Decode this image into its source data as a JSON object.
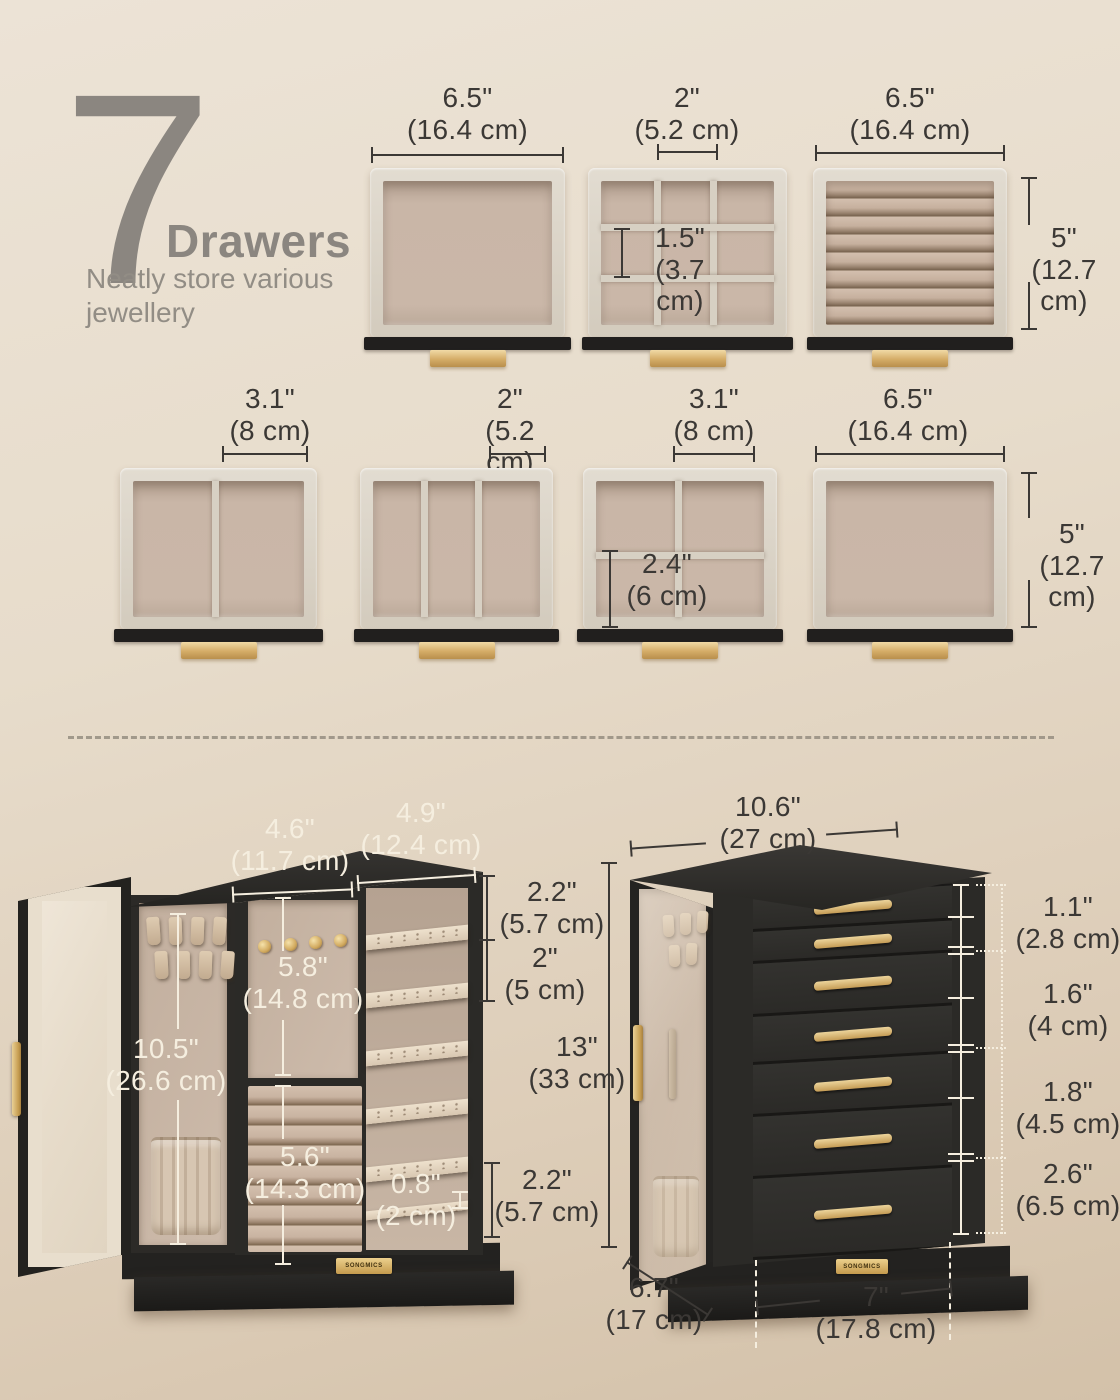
{
  "title": {
    "number": "7",
    "word": "Drawers",
    "subtitle_line1": "Neatly store various",
    "subtitle_line2": "jewellery"
  },
  "row1": [
    {
      "width_in": "6.5\"",
      "width_cm": "(16.4 cm)"
    },
    {
      "width_in": "2\"",
      "width_cm": "(5.2 cm)",
      "cell_in": "1.5\"",
      "cell_cm": "(3.7 cm)"
    },
    {
      "width_in": "6.5\"",
      "width_cm": "(16.4 cm)",
      "height_in": "5\"",
      "height_cm": "(12.7 cm)"
    }
  ],
  "row2": [
    {
      "width_in": "3.1\"",
      "width_cm": "(8 cm)"
    },
    {
      "width_in": "2\"",
      "width_cm": "(5.2 cm)"
    },
    {
      "width_in": "3.1\"",
      "width_cm": "(8 cm)",
      "cell_in": "2.4\"",
      "cell_cm": "(6 cm)"
    },
    {
      "width_in": "6.5\"",
      "width_cm": "(16.4 cm)",
      "height_in": "5\"",
      "height_cm": "(12.7 cm)"
    }
  ],
  "open_cabinet": {
    "logo": "SONGMICS",
    "dims": {
      "top_left": {
        "in": "4.6\"",
        "cm": "(11.7 cm)"
      },
      "top_right": {
        "in": "4.9\"",
        "cm": "(12.4 cm)"
      },
      "shelf_gap_top": {
        "in": "2.2\"",
        "cm": "(5.7 cm)"
      },
      "shelf_gap": {
        "in": "2\"",
        "cm": "(5 cm)"
      },
      "knob_panel": {
        "in": "5.8\"",
        "cm": "(14.8 cm)"
      },
      "door": {
        "in": "10.5\"",
        "cm": "(26.6 cm)"
      },
      "rolls": {
        "in": "5.6\"",
        "cm": "(14.3 cm)"
      },
      "lip": {
        "in": "0.8\"",
        "cm": "(2 cm)"
      },
      "bottom": {
        "in": "2.2\"",
        "cm": "(5.7 cm)"
      }
    }
  },
  "closed_cabinet": {
    "logo": "SONGMICS",
    "dims": {
      "width": {
        "in": "10.6\"",
        "cm": "(27 cm)"
      },
      "height": {
        "in": "13\"",
        "cm": "(33 cm)"
      },
      "drawer_small": {
        "in": "1.1\"",
        "cm": "(2.8 cm)"
      },
      "drawer_mid": {
        "in": "1.6\"",
        "cm": "(4 cm)"
      },
      "drawer_large": {
        "in": "1.8\"",
        "cm": "(4.5 cm)"
      },
      "drawer_xl": {
        "in": "2.6\"",
        "cm": "(6.5 cm)"
      },
      "depth": {
        "in": "6.7\"",
        "cm": "(17 cm)"
      },
      "front_width": {
        "in": "7\"",
        "cm": "(17.8 cm)"
      }
    }
  },
  "colors": {
    "background": "#e7dccc",
    "accent_gold": "#d2ab63",
    "cabinet_black": "#2b2a27",
    "velvet_frame": "#d7d0c4",
    "velvet_lining": "#c9b6a7",
    "text_dark": "#3b3835",
    "text_light": "#f5eedf",
    "title_gray": "#8b8680"
  }
}
